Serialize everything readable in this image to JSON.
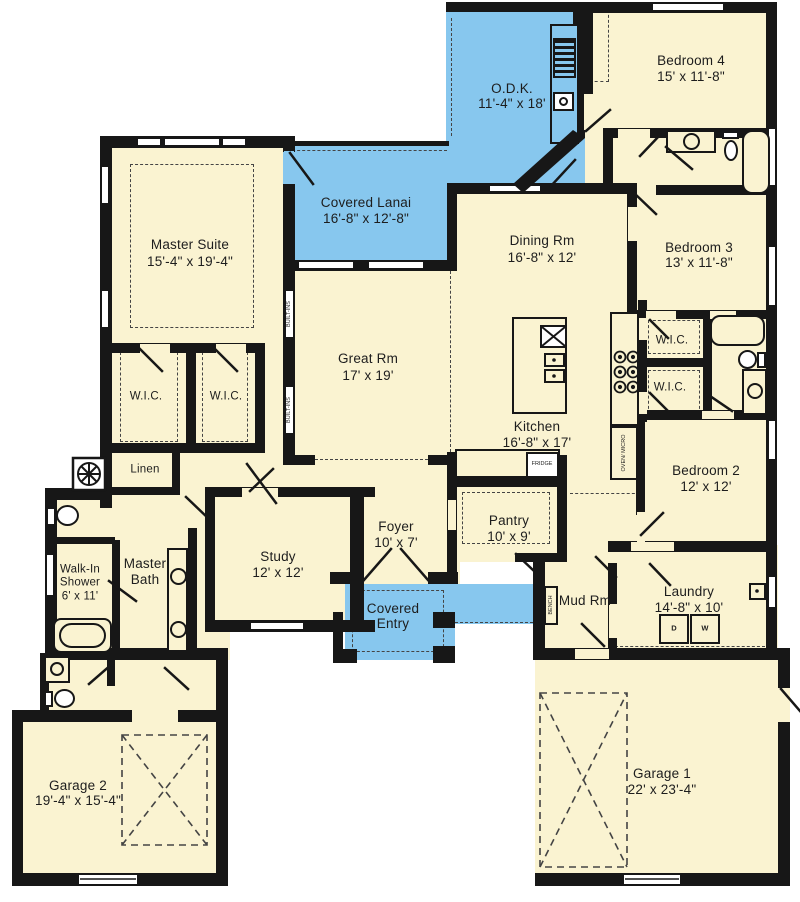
{
  "title": "Single-story house floor plan",
  "colors": {
    "room_fill": "#FAF3D1",
    "outdoor_fill": "#87C7EE",
    "wall": "#171717"
  },
  "rooms": {
    "odk": {
      "name": "O.D.K.",
      "dims": "11'-4\" x 18'"
    },
    "bedroom4": {
      "name": "Bedroom 4",
      "dims": "15' x 11'-8\""
    },
    "covered_lanai": {
      "name": "Covered Lanai",
      "dims": "16'-8\" x 12'-8\""
    },
    "master_suite": {
      "name": "Master Suite",
      "dims": "15'-4\" x 19'-4\""
    },
    "dining": {
      "name": "Dining Rm",
      "dims": "16'-8\" x 12'"
    },
    "bedroom3": {
      "name": "Bedroom 3",
      "dims": "13' x 11'-8\""
    },
    "great_rm": {
      "name": "Great Rm",
      "dims": "17' x 19'"
    },
    "kitchen": {
      "name": "Kitchen",
      "dims": "16'-8\" x 17'"
    },
    "bedroom2": {
      "name": "Bedroom 2",
      "dims": "12' x 12'"
    },
    "study": {
      "name": "Study",
      "dims": "12' x 12'"
    },
    "foyer": {
      "name": "Foyer",
      "dims": "10' x 7'"
    },
    "pantry": {
      "name": "Pantry",
      "dims": "10' x 9'"
    },
    "laundry": {
      "name": "Laundry",
      "dims": "14'-8\" x 10'"
    },
    "garage2": {
      "name": "Garage 2",
      "dims": "19'-4\" x 15'-4\""
    },
    "garage1": {
      "name": "Garage 1",
      "dims": "22' x 23'-4\""
    },
    "walk_in_shower": {
      "line1": "Walk-In",
      "line2": "Shower",
      "dims": "6' x 11'"
    },
    "master_bath": {
      "line1": "Master",
      "line2": "Bath"
    },
    "covered_entry": {
      "line1": "Covered",
      "line2": "Entry"
    },
    "mud_rm": {
      "name": "Mud Rm"
    }
  },
  "labels": {
    "wic": "W.I.C.",
    "linen": "Linen",
    "built_ins": "BUILT-INS",
    "oven_micro": "OVEN/ MICRO",
    "fridge": "FRIDGE",
    "bench": "BENCH",
    "dryer": "D",
    "washer": "W"
  }
}
